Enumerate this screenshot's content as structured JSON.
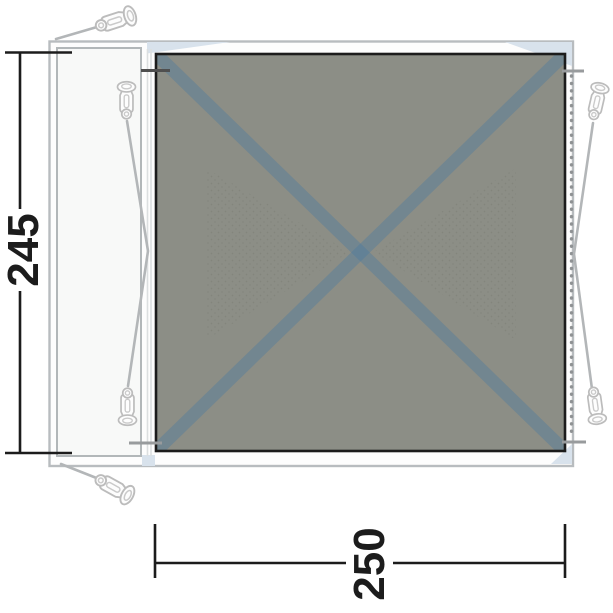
{
  "diagram": {
    "type": "footprint-groundsheet-dimension-diagram",
    "height_label": "245",
    "width_label": "250",
    "icons": {
      "tent_peg": "tent-peg-icon",
      "stitch_line": "stitch-line-dots"
    },
    "colors": {
      "ground-gray": "#8c8e86",
      "cross-blue": "#4a7aa0",
      "fold-blue": "#d8e2ec",
      "outline-gray": "#b8bcbf",
      "panel-border": "#b2b7b9",
      "ink-black": "#1c1c1c",
      "peg-gray": "#bcbcbc",
      "guyline-gray": "#b3b6b8",
      "stitch-gray": "#8f9294"
    }
  }
}
